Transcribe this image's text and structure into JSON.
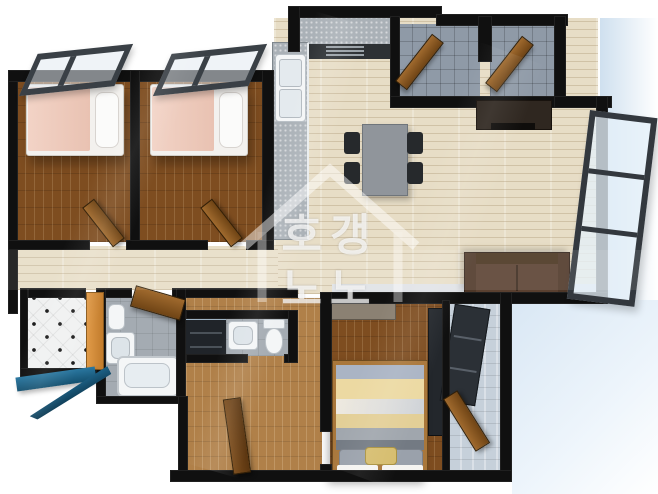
{
  "watermark": {
    "line1": "호갱",
    "line2": "노노",
    "icon": "house-outline-icon"
  },
  "palette": {
    "wall": "#101010",
    "bedroom_wood": "#7e4d20",
    "corridor_wood": "#b08049",
    "living_wood": "#e7ddc6",
    "entry_tile": "#8f9aa7",
    "bath_tile": "#a4abb2",
    "balcony_tile": "#c6d0da",
    "utility_tile": "#f0f1f1",
    "orange_door": "#d8913f",
    "wood_door": "#a06a2e",
    "sofa_brown": "#5a4030",
    "tv_cabinet": "#2f2720",
    "bed_blanket_pink": "#efc9ba",
    "bed_stripe_yellow": "#ecd9a2",
    "bed_stripe_gray": "#9aa0a6",
    "blue_window": "#1d6389",
    "exterior_shadow": "#d7e5f2",
    "window_frame": "#3a4046"
  },
  "rooms": [
    {
      "name": "bedroom-1"
    },
    {
      "name": "bedroom-2"
    },
    {
      "name": "kitchen"
    },
    {
      "name": "living-dining-room"
    },
    {
      "name": "entry-hall"
    },
    {
      "name": "pantry-room"
    },
    {
      "name": "hallway"
    },
    {
      "name": "utility-balcony"
    },
    {
      "name": "bathroom-1"
    },
    {
      "name": "bathroom-2"
    },
    {
      "name": "master-bedroom"
    },
    {
      "name": "master-balcony"
    }
  ]
}
